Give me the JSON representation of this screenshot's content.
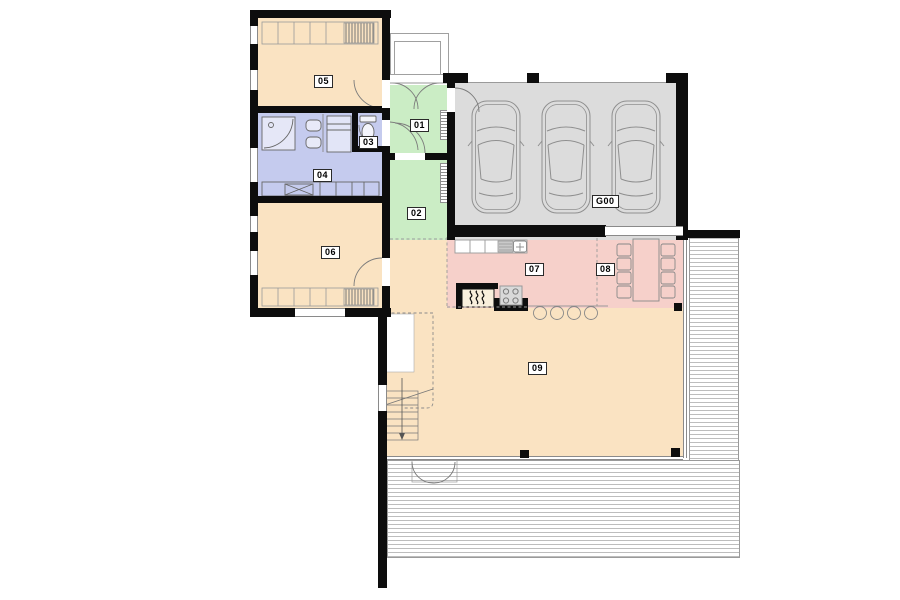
{
  "plan": {
    "kind": "architectural floor plan",
    "rooms": [
      {
        "id": "01",
        "zone": "entry-hall",
        "fill": "#CBEDC5"
      },
      {
        "id": "02",
        "zone": "hallway",
        "fill": "#CBEDC5"
      },
      {
        "id": "03",
        "zone": "wc",
        "fill": "#C5CBEE"
      },
      {
        "id": "04",
        "zone": "bathroom",
        "fill": "#C5CBEE"
      },
      {
        "id": "05",
        "zone": "bedroom",
        "fill": "#FAE3C2"
      },
      {
        "id": "06",
        "zone": "bedroom",
        "fill": "#FAE3C2"
      },
      {
        "id": "07",
        "zone": "kitchen",
        "fill": "#F6D0CA"
      },
      {
        "id": "08",
        "zone": "dining",
        "fill": "#F6D0CA"
      },
      {
        "id": "09",
        "zone": "living-room",
        "fill": "#FAE3C2"
      },
      {
        "id": "G00",
        "zone": "garage",
        "fill": "#DCDCDC"
      }
    ],
    "colors": {
      "wall": "#0D0D0D",
      "linework": "#8F8F8F",
      "deck_line": "#BDBDBD",
      "warm": "#FAE3C2",
      "green": "#CBEDC5",
      "blue": "#C5CBEE",
      "pink": "#F6D0CA",
      "garage_gray": "#DCDCDC"
    },
    "counts": {
      "garage_cars": 3,
      "dining_chairs": 8,
      "bar_stools": 4
    },
    "icons": [
      "car-icon",
      "fireplace-icon",
      "cooktop-icon",
      "kitchen-sink-icon",
      "shower-icon",
      "toilet-icon",
      "washbasin-icon",
      "stairs-icon",
      "wardrobe-icon",
      "dining-table-icon",
      "radiator-icon",
      "door-swing-icon",
      "terrace-decking"
    ]
  }
}
